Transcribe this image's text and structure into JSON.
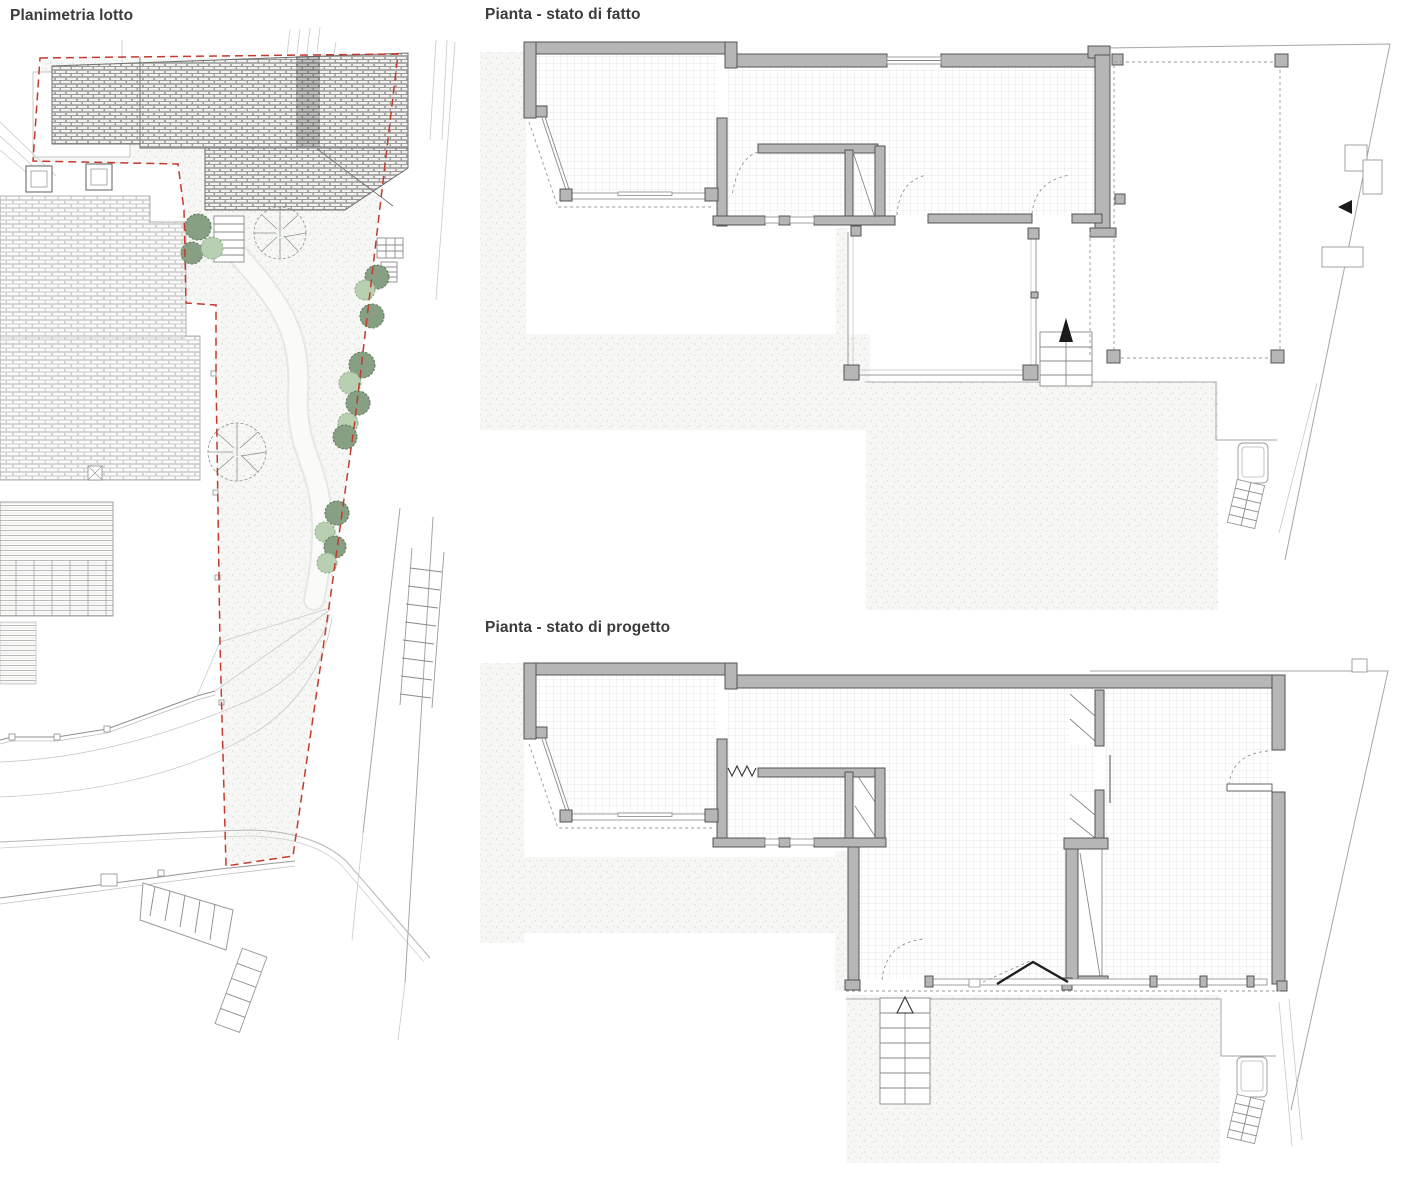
{
  "panels": {
    "site_plan": {
      "title": "Planimetria lotto"
    },
    "plan_existing": {
      "title": "Pianta - stato di fatto"
    },
    "plan_project": {
      "title": "Pianta - stato di progetto"
    }
  },
  "colors": {
    "paper": "#ffffff",
    "boundary_red": "#c43a2c",
    "wall_gray": "#b6b6b6",
    "wall_outline": "#545454",
    "floor_grid": "#e2e3e5",
    "ground_stipple": "#cfd4cf",
    "tree_dark": "#87a083",
    "tree_light": "#b9cfb2"
  }
}
